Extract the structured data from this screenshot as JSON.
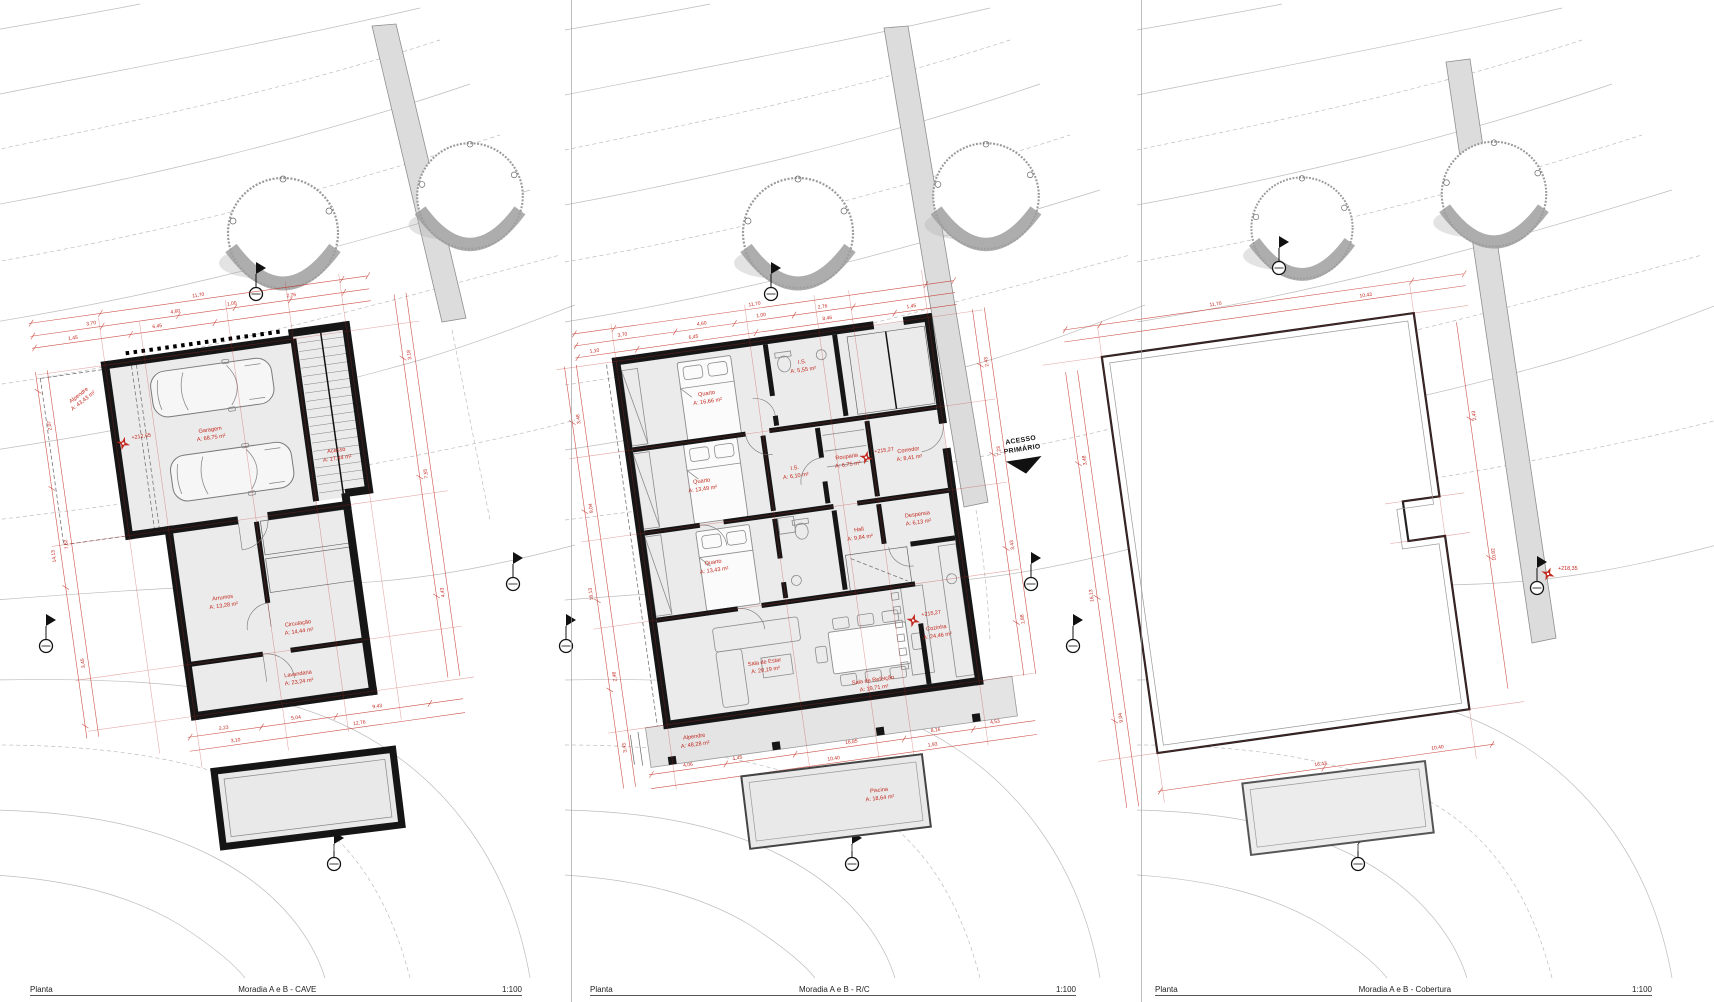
{
  "colors": {
    "red": "#c2281e",
    "wall": "#161616",
    "room_fill": "#ebebeb"
  },
  "footers": [
    {
      "drawing_type": "Planta",
      "title": "Moradia A e B - CAVE",
      "scale": "1:100"
    },
    {
      "drawing_type": "Planta",
      "title": "Moradia A e B - R/C",
      "scale": "1:100"
    },
    {
      "drawing_type": "Planta",
      "title": "Moradia A e B - Cobertura",
      "scale": "1:100"
    }
  ],
  "cave": {
    "level": "+212,65",
    "rooms": {
      "alpendre": {
        "name": "Alpendre",
        "area": "A: 43,43 m²"
      },
      "garagem": {
        "name": "Garagem",
        "area": "A: 68,75 m²"
      },
      "acesso": {
        "name": "Acesso",
        "area": "A: 17,44 m²"
      },
      "arrumos": {
        "name": "Arrumos",
        "area": "A: 13,28 m²"
      },
      "circulacao": {
        "name": "Circulação",
        "area": "A: 14,44 m²"
      },
      "lavandaria": {
        "name": "Lavandaria",
        "area": "A: 23,24 m²"
      }
    },
    "dims_top": [
      "11,70",
      "3,70",
      "4,60",
      "1,00",
      "2,76",
      "6,45",
      "1,45"
    ],
    "dims_left": [
      "2,07",
      "7,62",
      "3,45",
      "14,13"
    ],
    "dims_right": [
      "3,18",
      "7,55",
      "4,43"
    ],
    "dims_bottom": [
      "2,23",
      "5,04",
      "9,43",
      "12,76",
      "3,10"
    ]
  },
  "rc": {
    "level_entrance": "+215,27",
    "level_hall": "+215,27",
    "access_line1": "ACESSO",
    "access_line2": "PRIMÁRIO",
    "rooms": {
      "quarto1": {
        "name": "Quarto",
        "area": "A: 16,66 m²"
      },
      "is1": {
        "name": "I.S.",
        "area": "A: 5,55 m²"
      },
      "rouparia": {
        "name": "Rouparia",
        "area": "A: 6,75 m²"
      },
      "quarto2": {
        "name": "Quarto",
        "area": "A: 13,49 m²"
      },
      "is2": {
        "name": "I.S.",
        "area": "A: 6,10 m²"
      },
      "corredor": {
        "name": "Corredor",
        "area": "A: 8,41 m²"
      },
      "quarto3": {
        "name": "Quarto",
        "area": "A: 13,43 m²"
      },
      "hall": {
        "name": "Hall",
        "area": "A: 9,84 m²"
      },
      "despensa": {
        "name": "Despensa",
        "area": "A: 6,13 m²"
      },
      "cozinha": {
        "name": "Cozinha",
        "area": "A: 24,46 m²"
      },
      "sala_estar": {
        "name": "Sala de Estar",
        "area": "A: 20,19 m²"
      },
      "sala_refeicao": {
        "name": "Sala de Refeição",
        "area": "A: 19,71 m²"
      },
      "alpendre": {
        "name": "Alpendre",
        "area": "A: 48,28 m²"
      },
      "piscina": {
        "name": "Piscina",
        "area": "A: 18,64 m²"
      }
    },
    "dims_top": [
      "11,70",
      "3,70",
      "4,60",
      "1,00",
      "2,76",
      "1,10",
      "6,45",
      "8,46",
      "1,45"
    ],
    "dims_left": [
      "3,48",
      "9,04",
      "16,13",
      "2,48",
      "3,43"
    ],
    "dims_right": [
      "2,43",
      "7,23",
      "3,43",
      "1,88"
    ],
    "dims_bottom": [
      "4,06",
      "1,45",
      "16,85",
      "8,16",
      "4,53",
      "10,40",
      "1,93"
    ]
  },
  "cobertura": {
    "level": "+218,35",
    "dims_top": [
      "11,70",
      "10,43"
    ],
    "dims_left": [
      "3,48",
      "16,13",
      "9,04"
    ],
    "dims_right": [
      "2,43",
      "10,82"
    ],
    "dims_bottom": [
      "16,43",
      "10,40"
    ]
  }
}
